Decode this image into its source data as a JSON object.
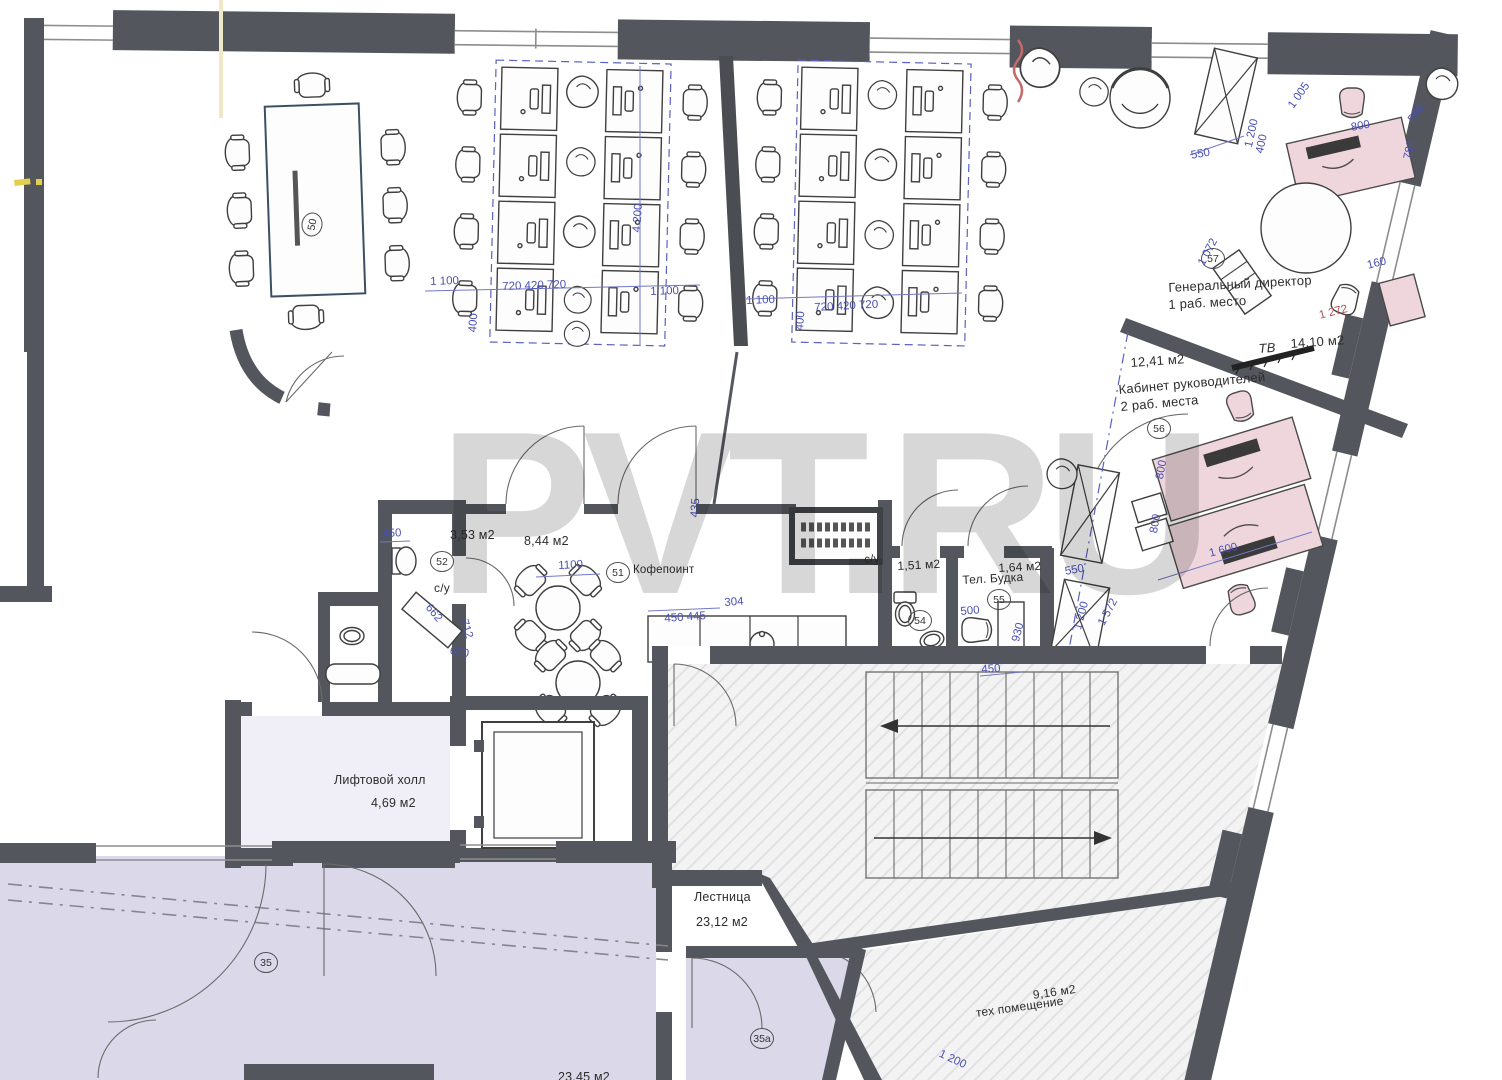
{
  "watermark": "PVT.RU",
  "colors": {
    "wall": "#53565c",
    "dimension_blue": "#4a50b4",
    "dimension_red": "#b4504f",
    "room_lavender": "#dbd8e9",
    "furniture_pink": "#eed6dc",
    "watermark_gray": "#d7d7d7",
    "floor_hatch": "#f3f3f4"
  },
  "rooms": {
    "conference": {
      "marker": "50"
    },
    "director": {
      "title": "Генеральный директор",
      "subtitle": "1 раб. место",
      "tv_label": "ТВ",
      "tv_area": "14,10 м2",
      "marker": "57"
    },
    "managers": {
      "area": "12,41 м2",
      "title": "Кабинет руководителей",
      "subtitle": "2 раб. места",
      "marker": "56"
    },
    "wc_small": {
      "area": "3,53 м2",
      "label": "с/у",
      "marker": "52"
    },
    "coffee": {
      "area": "8,44 м2",
      "name": "Кофепоинт",
      "marker": "51"
    },
    "wc_mid": {
      "label": "с/у",
      "area": "1,51 м2",
      "marker": "54"
    },
    "phone_booth": {
      "name": "Тел. Будка",
      "area": "1,64 м2",
      "marker": "55"
    },
    "lift_hall": {
      "name": "Лифтовой холл",
      "area": "4,69 м2"
    },
    "stairs": {
      "name": "Лестница",
      "area": "23,12 м2"
    },
    "tech": {
      "area": "9,16 м2",
      "name": "тех помещение"
    },
    "hall_35": {
      "marker": "35"
    },
    "hall_35a": {
      "marker": "35а"
    },
    "bottom_room": {
      "area": "23,45 м2"
    }
  },
  "dimensions": {
    "d1": "1 100",
    "d2": "720 420 720",
    "d3": "400",
    "d4": "4 200",
    "d5": "1 100",
    "d6": "1 100",
    "d7": "720 420 720",
    "d8": "400",
    "d9": "550",
    "d10": "1 200",
    "d11": "1 005",
    "d12": "800",
    "d13": "590",
    "d14": "780",
    "d15": "400",
    "d16": "1 072",
    "d17": "160",
    "d18": "1 272",
    "d19": "550",
    "d20": "1 200",
    "d21": "1 572",
    "d22": "500",
    "d23": "930",
    "d24": "450",
    "d25": "662",
    "d26": "712",
    "d27": "650",
    "d28": "1100",
    "d29": "450 445",
    "d30": "304",
    "d31": "435",
    "d32": "450",
    "d33": "1 200",
    "d34": "800",
    "d35": "800",
    "d36": "1 600"
  }
}
